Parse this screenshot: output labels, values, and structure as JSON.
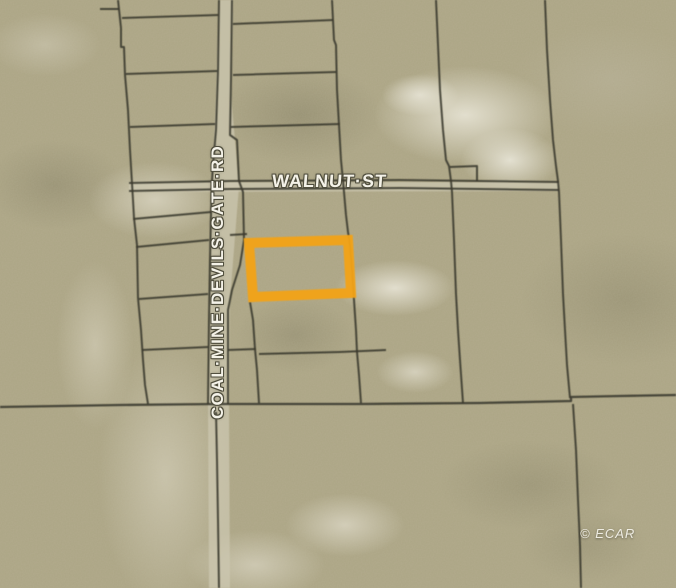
{
  "map": {
    "type": "satellite-parcel-map",
    "labels": {
      "street_horizontal": "WALNUT·ST",
      "street_vertical": "COAL·MINE·DEVILS·GATE·RD",
      "watermark": "© ECAR"
    },
    "colors": {
      "highlight": "#F2A219",
      "parcel_line": "#3a382c",
      "terrain_base": "#aca585",
      "road_fill": "#cdc8b2",
      "label_text": "#f4f2e8"
    }
  }
}
